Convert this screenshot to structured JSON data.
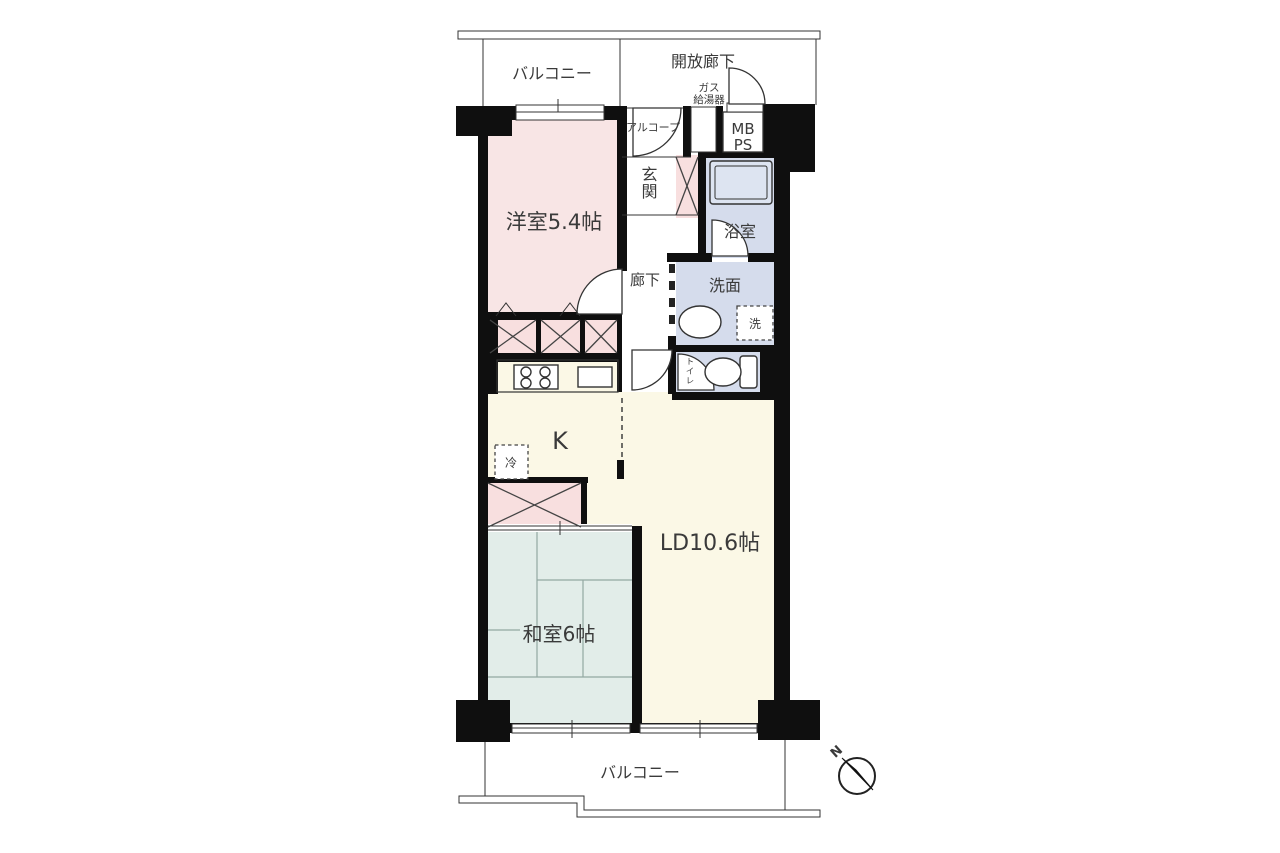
{
  "labels": {
    "balcony_top": "バルコニー",
    "open_corridor": "開放廊下",
    "gas_heater_line1": "ガス",
    "gas_heater_line2": "給湯器",
    "alcove": "アルコープ",
    "meter_box": "MB",
    "pipe_space": "PS",
    "entrance": "玄関",
    "bathroom": "浴室",
    "washroom": "洗面",
    "washer": "洗",
    "toilet": "トイレ",
    "corridor": "廊下",
    "western_room": "洋室5.4帖",
    "kitchen": "K",
    "refrigerator": "冷",
    "living_dining": "LD10.6帖",
    "japanese_room": "和室6帖",
    "balcony_bottom": "バルコニー",
    "compass_north": "N"
  },
  "colors": {
    "wall": "#0f0f0f",
    "western_room": "#f8e5e5",
    "closet": "#f8dfdf",
    "japanese_room": "#e2ede9",
    "living_dining": "#fbf8e6",
    "wet_area": "#d5dcec",
    "tub": "#dde4f1",
    "white": "#ffffff"
  }
}
